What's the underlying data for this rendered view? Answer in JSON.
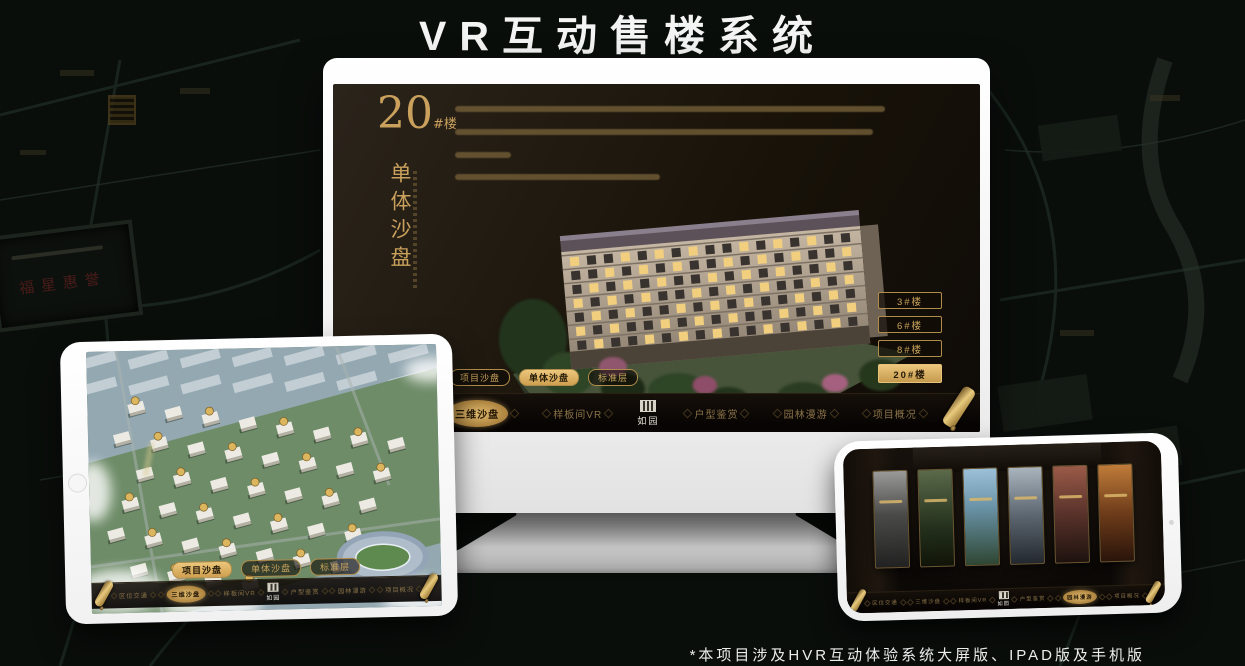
{
  "page": {
    "title": "VR互动售楼系统",
    "footnote": "*本项目涉及HVR互动体验系统大屏版、IPAD版及手机版"
  },
  "colors": {
    "gold": "#c9a05c",
    "gold_bright": "#ecc77c",
    "screen_bg": "#191309",
    "nav_bg": "#0c0906",
    "seal_red": "#5d1f1f"
  },
  "icons": {
    "scroll": "gold-scroll-icon",
    "seal": "brand-seal-icon",
    "home": "tablet-home-button",
    "camera": "phone-camera-dot"
  },
  "monitor": {
    "heading": {
      "number": "20",
      "suffix": "#楼",
      "subtitle": "单体沙盘"
    },
    "floor_buttons": [
      {
        "label": "3#楼",
        "selected": false
      },
      {
        "label": "6#楼",
        "selected": false
      },
      {
        "label": "8#楼",
        "selected": false
      },
      {
        "label": "20#楼",
        "selected": true
      }
    ],
    "tabs": [
      {
        "label": "项目沙盘",
        "selected": false
      },
      {
        "label": "单体沙盘",
        "selected": true
      },
      {
        "label": "标准层",
        "selected": false
      }
    ],
    "nav": {
      "logo": "如园",
      "items": [
        {
          "label": "区位交通",
          "selected": false
        },
        {
          "label": "三维沙盘",
          "selected": true
        },
        {
          "label": "样板间VR",
          "selected": false
        },
        {
          "label": "户型鉴赏",
          "selected": false
        },
        {
          "label": "园林漫游",
          "selected": false
        },
        {
          "label": "项目概况",
          "selected": false
        }
      ]
    }
  },
  "tablet": {
    "tabs": [
      {
        "label": "项目沙盘",
        "selected": true
      },
      {
        "label": "单体沙盘",
        "selected": false
      },
      {
        "label": "标准层",
        "selected": false
      }
    ],
    "nav": {
      "logo": "如园",
      "items": [
        {
          "label": "区位交通",
          "selected": false
        },
        {
          "label": "三维沙盘",
          "selected": true
        },
        {
          "label": "样板间VR",
          "selected": false
        },
        {
          "label": "户型鉴赏",
          "selected": false
        },
        {
          "label": "园林漫游",
          "selected": false
        },
        {
          "label": "项目概况",
          "selected": false
        }
      ]
    }
  },
  "phone": {
    "nav": {
      "logo": "如园",
      "items": [
        {
          "label": "区位交通",
          "selected": false
        },
        {
          "label": "三维沙盘",
          "selected": false
        },
        {
          "label": "样板间VR",
          "selected": false
        },
        {
          "label": "户型鉴赏",
          "selected": false
        },
        {
          "label": "园林漫游",
          "selected": true
        },
        {
          "label": "项目概况",
          "selected": false
        }
      ]
    }
  },
  "background": {
    "plaque_seal_text": "福星惠誉"
  }
}
